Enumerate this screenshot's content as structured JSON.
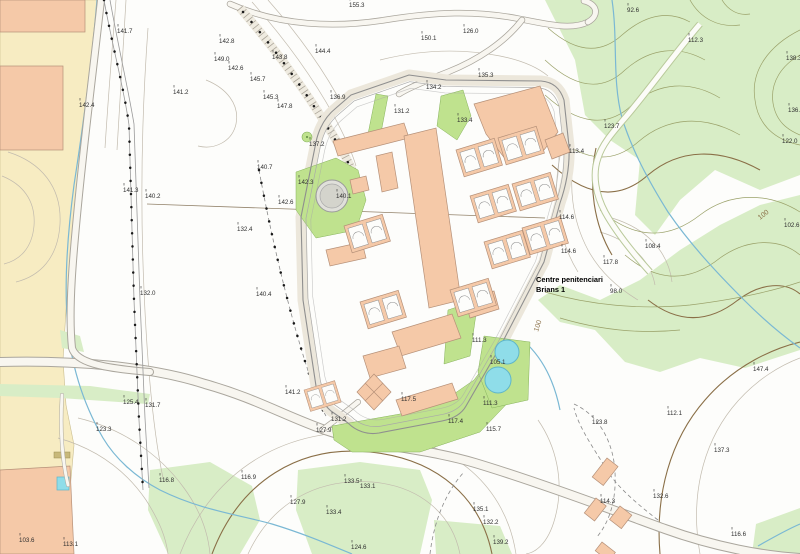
{
  "map": {
    "place_label": {
      "line1": "Centre penitenciari",
      "line2": "Brians 1"
    },
    "contour_labels": [
      {
        "x": 538,
        "y": 332,
        "v": "100",
        "rot": -72
      },
      {
        "x": 760,
        "y": 220,
        "v": "100",
        "rot": -38
      }
    ],
    "elevation_labels": [
      {
        "x": 117,
        "y": 33,
        "v": "141.7"
      },
      {
        "x": 173,
        "y": 94,
        "v": "141.2"
      },
      {
        "x": 79,
        "y": 107,
        "v": "142.4"
      },
      {
        "x": 219,
        "y": 43,
        "v": "142.8"
      },
      {
        "x": 214,
        "y": 61,
        "v": "149.0"
      },
      {
        "x": 228,
        "y": 70,
        "v": "142.6"
      },
      {
        "x": 250,
        "y": 81,
        "v": "145.7"
      },
      {
        "x": 263,
        "y": 99,
        "v": "145.3"
      },
      {
        "x": 277,
        "y": 108,
        "v": "147.8"
      },
      {
        "x": 315,
        "y": 53,
        "v": "144.4"
      },
      {
        "x": 272,
        "y": 59,
        "v": "143.8"
      },
      {
        "x": 349,
        "y": 7,
        "v": "155.3"
      },
      {
        "x": 421,
        "y": 40,
        "v": "150.1"
      },
      {
        "x": 463,
        "y": 33,
        "v": "126.0"
      },
      {
        "x": 478,
        "y": 77,
        "v": "135.3"
      },
      {
        "x": 330,
        "y": 99,
        "v": "136.9"
      },
      {
        "x": 309,
        "y": 146,
        "v": "137.2"
      },
      {
        "x": 257,
        "y": 169,
        "v": "140.7"
      },
      {
        "x": 278,
        "y": 204,
        "v": "142.6"
      },
      {
        "x": 237,
        "y": 231,
        "v": "132.4"
      },
      {
        "x": 123,
        "y": 192,
        "v": "141.3"
      },
      {
        "x": 145,
        "y": 198,
        "v": "140.2"
      },
      {
        "x": 140,
        "y": 295,
        "v": "132.0"
      },
      {
        "x": 256,
        "y": 296,
        "v": "140.4"
      },
      {
        "x": 298,
        "y": 184,
        "v": "142.3"
      },
      {
        "x": 336,
        "y": 198,
        "v": "140.1"
      },
      {
        "x": 394,
        "y": 113,
        "v": "131.2"
      },
      {
        "x": 426,
        "y": 89,
        "v": "134.2"
      },
      {
        "x": 457,
        "y": 122,
        "v": "133.4"
      },
      {
        "x": 569,
        "y": 153,
        "v": "113.4"
      },
      {
        "x": 559,
        "y": 219,
        "v": "114.6"
      },
      {
        "x": 561,
        "y": 253,
        "v": "114.6"
      },
      {
        "x": 603,
        "y": 264,
        "v": "117.8"
      },
      {
        "x": 610,
        "y": 293,
        "v": "98.0"
      },
      {
        "x": 627,
        "y": 12,
        "v": "92.6"
      },
      {
        "x": 688,
        "y": 42,
        "v": "112.3"
      },
      {
        "x": 786,
        "y": 60,
        "v": "138.3"
      },
      {
        "x": 788,
        "y": 112,
        "v": "136.3"
      },
      {
        "x": 604,
        "y": 128,
        "v": "123.7"
      },
      {
        "x": 782,
        "y": 143,
        "v": "122.0"
      },
      {
        "x": 784,
        "y": 227,
        "v": "102.6"
      },
      {
        "x": 645,
        "y": 248,
        "v": "108.4"
      },
      {
        "x": 753,
        "y": 371,
        "v": "147.4"
      },
      {
        "x": 472,
        "y": 342,
        "v": "111.3"
      },
      {
        "x": 490,
        "y": 364,
        "v": "105.1"
      },
      {
        "x": 483,
        "y": 405,
        "v": "111.3"
      },
      {
        "x": 486,
        "y": 431,
        "v": "115.7"
      },
      {
        "x": 401,
        "y": 401,
        "v": "117.5"
      },
      {
        "x": 448,
        "y": 423,
        "v": "117.4"
      },
      {
        "x": 285,
        "y": 394,
        "v": "141.2"
      },
      {
        "x": 331,
        "y": 421,
        "v": "131.2"
      },
      {
        "x": 316,
        "y": 432,
        "v": "127.9"
      },
      {
        "x": 123,
        "y": 404,
        "v": "125.4"
      },
      {
        "x": 145,
        "y": 407,
        "v": "131.7"
      },
      {
        "x": 159,
        "y": 482,
        "v": "116.8"
      },
      {
        "x": 241,
        "y": 479,
        "v": "116.9"
      },
      {
        "x": 96,
        "y": 431,
        "v": "123.3"
      },
      {
        "x": 19,
        "y": 542,
        "v": "103.6"
      },
      {
        "x": 63,
        "y": 546,
        "v": "113.1"
      },
      {
        "x": 344,
        "y": 483,
        "v": "133.5"
      },
      {
        "x": 360,
        "y": 488,
        "v": "133.1"
      },
      {
        "x": 290,
        "y": 504,
        "v": "127.9"
      },
      {
        "x": 326,
        "y": 514,
        "v": "133.4"
      },
      {
        "x": 473,
        "y": 511,
        "v": "135.1"
      },
      {
        "x": 483,
        "y": 524,
        "v": "132.2"
      },
      {
        "x": 493,
        "y": 544,
        "v": "139.2"
      },
      {
        "x": 351,
        "y": 549,
        "v": "124.6"
      },
      {
        "x": 667,
        "y": 415,
        "v": "112.1"
      },
      {
        "x": 592,
        "y": 424,
        "v": "123.8"
      },
      {
        "x": 714,
        "y": 452,
        "v": "137.3"
      },
      {
        "x": 653,
        "y": 498,
        "v": "132.6"
      },
      {
        "x": 600,
        "y": 503,
        "v": "114.3"
      },
      {
        "x": 731,
        "y": 536,
        "v": "116.6"
      }
    ],
    "colors": {
      "building": "#f5c9a8",
      "building_outline": "#b59078",
      "forest": "#d8edc6",
      "lawn": "#bfe28e",
      "water": "#8fdde9",
      "stream": "#7ab8d4",
      "urban_zone": "#f7ecc2",
      "contour": "#c2bbae",
      "contour_forest": "#9aa169",
      "contour_index": "#8a6f47",
      "wall": "#8f8f8f",
      "label_text": "#2f2f2f"
    },
    "features": {
      "prison": "walled prison complex",
      "water_tank": "circular water tank",
      "pools": "two circular water basins",
      "forest": "wooded hillside with contour lines",
      "stream": "stream",
      "roads": "access roads",
      "urban_plots": "urbanized plots with buildings"
    }
  }
}
